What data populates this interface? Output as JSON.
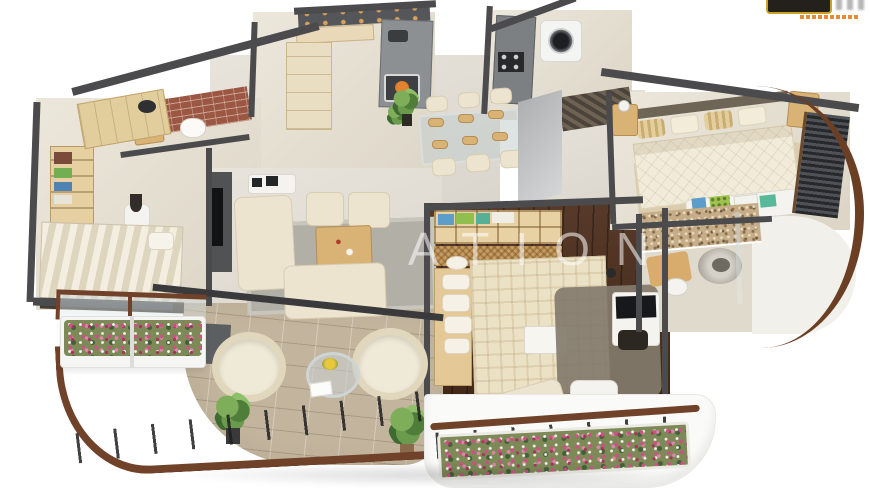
{
  "scene": {
    "type": "3d-floor-plan-render",
    "style": "isometric top-down apartment 3D render on white background",
    "watermark": {
      "text": "ATION",
      "color": "rgba(255,255,255,0.55)"
    },
    "brand_logo": {
      "badge_color": "#24201c",
      "trim_color": "#c9a227",
      "tagline_color": "#e07f1f"
    },
    "palette": {
      "background": "#ffffff",
      "walls": "#4b4b4d",
      "floor_beige": "#e7e1d4",
      "floor_dark_wood": "#4a2b19",
      "floor_stone": "#c3b59d",
      "sofa_cream": "#ece4cf",
      "wood_tan": "#d9b276",
      "rail_wood": "#70422a",
      "flowers_pink": "#cf4f86",
      "plant_green": "#5e8a48",
      "brick_red": "#9c5742"
    },
    "rooms": [
      {
        "name": "kitchen",
        "furniture": [
          "dark-top-counter",
          "upper-cabinets",
          "tall-cabinet",
          "island-counter",
          "sink",
          "microwave",
          "potted-plant"
        ]
      },
      {
        "name": "utility-laundry",
        "furniture": [
          "gray-counter",
          "cooktop",
          "washing-machine",
          "striped-mat"
        ]
      },
      {
        "name": "dining-area",
        "furniture": [
          "glass-dining-table",
          "six-cream-chairs",
          "tan-placemats",
          "potted-plant",
          "gray-angled-wall"
        ]
      },
      {
        "name": "living-room",
        "furniture": [
          "three-seat-cream-sofa",
          "two-seat-cream-sofa",
          "two-ottomans",
          "wood-coffee-table",
          "gray-rug",
          "tv-wall-unit",
          "media-shelf"
        ]
      },
      {
        "name": "left-bedroom",
        "furniture": [
          "striped-double-bed",
          "dark-headboard",
          "wardrobe-shelves-with-clothes",
          "side-table-with-dark-vase",
          "chaise"
        ]
      },
      {
        "name": "left-bathroom",
        "furniture": [
          "brick-accent-wall",
          "toilet",
          "vanity-with-round-basin"
        ]
      },
      {
        "name": "master-bedroom",
        "furniture": [
          "plaid-double-bed",
          "pillow-column",
          "light-wood-headboard",
          "open-wardrobe-cubbies-with-clothes",
          "wicker-front-drawers",
          "dresser-with-tv",
          "dark-stool",
          "gray-rug",
          "lounge-chair",
          "white-ottoman",
          "breakfast-tray"
        ]
      },
      {
        "name": "top-right-bedroom",
        "furniture": [
          "quilted-double-bed",
          "striped-pillows",
          "two-nightstands-with-lamps",
          "foot-bench-with-folded-clothes",
          "louvered-dark-wardrobe",
          "beige-rug"
        ]
      },
      {
        "name": "right-bathroom",
        "furniture": [
          "pebble-accent-wall",
          "round-stone-basin",
          "toilet",
          "tan-bath-mat",
          "glass-screen"
        ]
      },
      {
        "name": "terrace-balcony",
        "furniture": [
          "two-round-wicker-armchairs",
          "round-glass-table-with-yellow-flowers",
          "white-card",
          "two-potted-plants",
          "dark-bench",
          "curved-railing-wood-handrail"
        ]
      },
      {
        "name": "flower-balcony",
        "furniture": [
          "pink-flower-planter-strip",
          "wood-handrail",
          "railing-posts",
          "green-shrub"
        ]
      },
      {
        "name": "left-planter-balcony",
        "furniture": [
          "pink-flower-boxes",
          "glass-and-wood-screen",
          "dark-slab"
        ]
      },
      {
        "name": "curved-facade",
        "furniture": [
          "curved-brown-window-band",
          "white-curved-floor"
        ]
      }
    ]
  }
}
